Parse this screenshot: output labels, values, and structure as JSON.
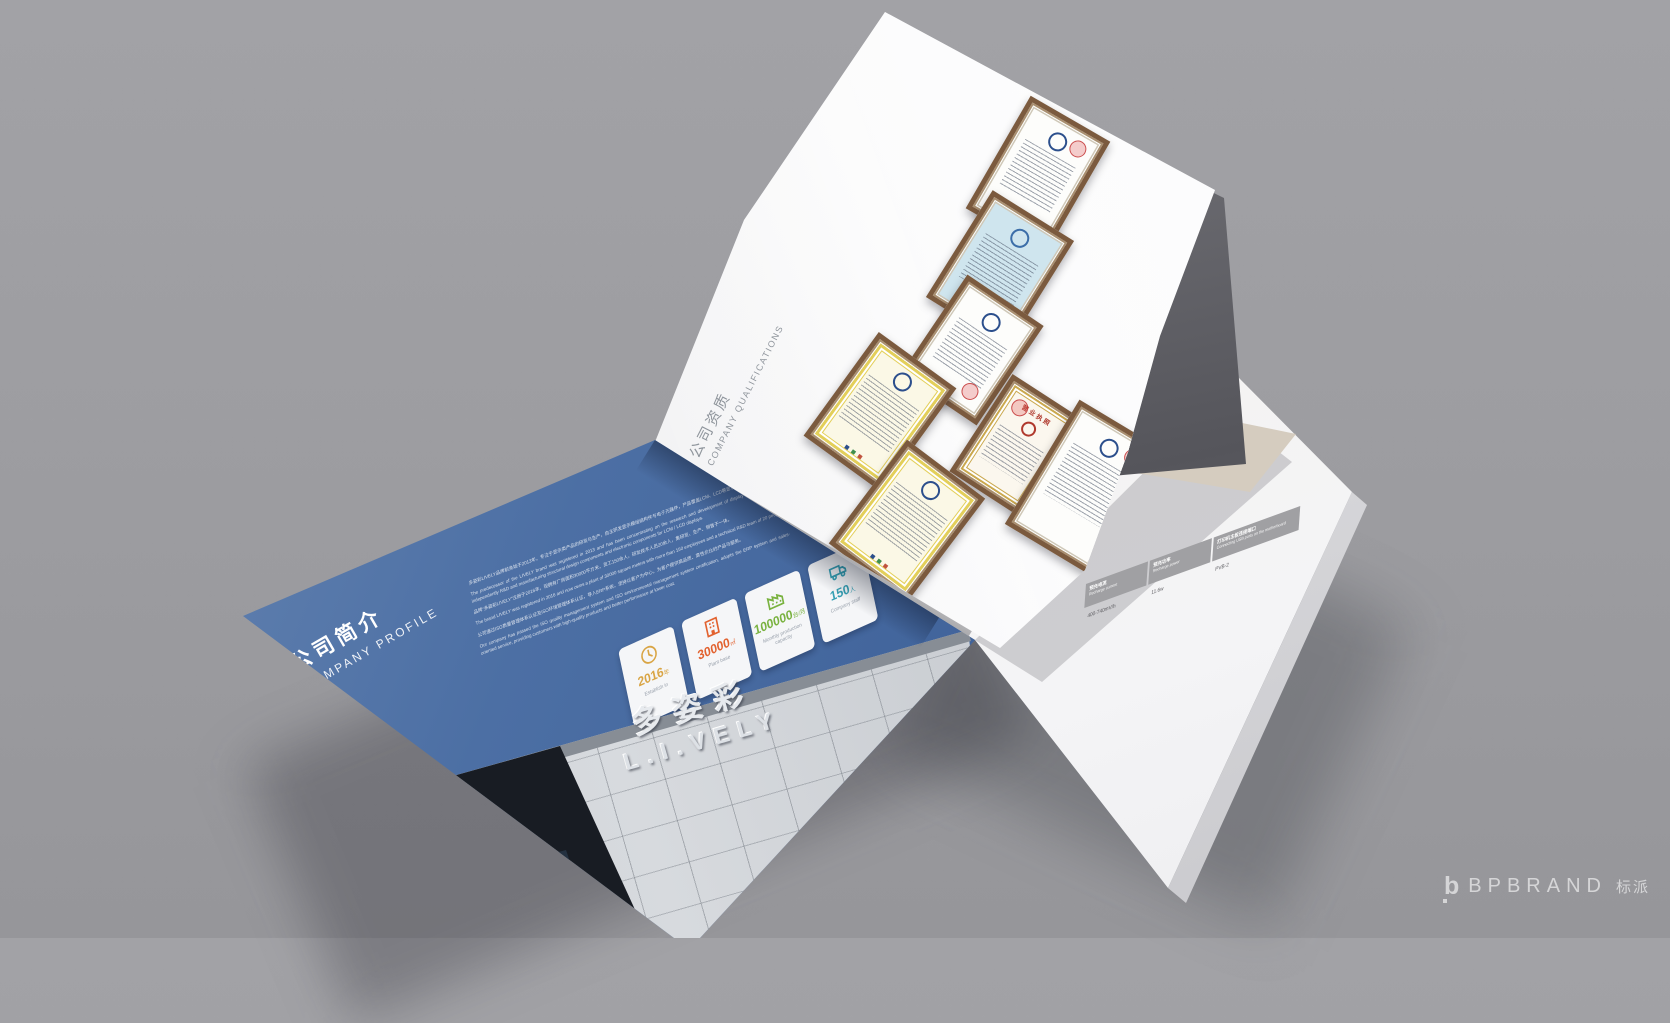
{
  "scene": {
    "background_color": "#9c9ca0",
    "palette": {
      "page_blue": "#45699f",
      "cert_frame_brown": "#7b5a3e",
      "stack_band_gray": "#55555b"
    },
    "watermark": {
      "logo": "b",
      "brand": "BPBRAND",
      "brand_cn": "标派"
    }
  },
  "left_page": {
    "heading_cn": "公司简介",
    "heading_en": "COMPANY PROFILE",
    "paragraphs": [
      "多姿彩LIVELY品牌前身始于2013年，专注于显示类产品的研发与生产，自主研发显示模组结构件与电子元器件，产品覆盖LCM、LCD等显示终端产品。",
      "The predecessor of the LIVELY brand was registered in 2013 and has been concentrating on the research and development of display terminal products, independently R&D and manufacturing structural design components and electronic components for LCM / LCD displays.",
      "品牌“多姿彩LIVELY”注册于2016年，现拥有厂房面积30000平方米，员工150余人，研发技术人员20余人，集研发、生产、销售于一体。",
      "The brand LIVELY was registered in 2016 and now owns a plant of 30000 square meters with more than 150 employees and a technical R&D team of 20 people.",
      "公司通过ISO质量管理体系认证及ISO环境管理体系认证，导入ERP系统，坚持以客户为中心，为客户提供高品质、高性价比的产品与服务。",
      "Our company has passed the ISO quality management system and ISO environmental management system certification, adopts the ERP system and sales-oriented service, providing customers with high-quality products and better performance at lower cost."
    ],
    "stats": [
      {
        "icon": "clock-icon",
        "value": "2016",
        "unit": "年",
        "label": "Establish in",
        "color": "#d9a545"
      },
      {
        "icon": "building-icon",
        "value": "30000",
        "unit": "㎡",
        "label": "Plant base",
        "color": "#e2622f"
      },
      {
        "icon": "factory-icon",
        "value": "100000",
        "unit": "台/月",
        "label": "Monthly production capacity",
        "color": "#79b23f"
      },
      {
        "icon": "truck-icon",
        "value": "150",
        "unit": "人",
        "label": "Company staff",
        "color": "#35a0b4"
      }
    ],
    "building_sign_cn": "多姿彩",
    "building_sign_en": "L.I.VELY"
  },
  "flip_page": {
    "heading_cn": "公司资质",
    "heading_en": "COMPANY QUALIFICATIONS",
    "certificates": [
      {
        "name": "patent-certificate"
      },
      {
        "name": "ccc-certificate"
      },
      {
        "name": "qualification-certificate"
      },
      {
        "name": "iso-certificate-1"
      },
      {
        "name": "business-license",
        "title": "营业执照"
      },
      {
        "name": "iso-certificate-2"
      },
      {
        "name": "honor-certificate"
      }
    ]
  },
  "right_page": {
    "spec_table": {
      "columns": [
        {
          "header_cn": "预充电流",
          "header_en": "Recharge current",
          "value": "400-740mV/h"
        },
        {
          "header_cn": "预充功率",
          "header_en": "Recharge power",
          "value": "11.6w"
        },
        {
          "header_cn": "打印机主板连接端口",
          "header_en": "Connecting USB ports on the motherboard",
          "value": "PVB-2"
        }
      ]
    }
  }
}
